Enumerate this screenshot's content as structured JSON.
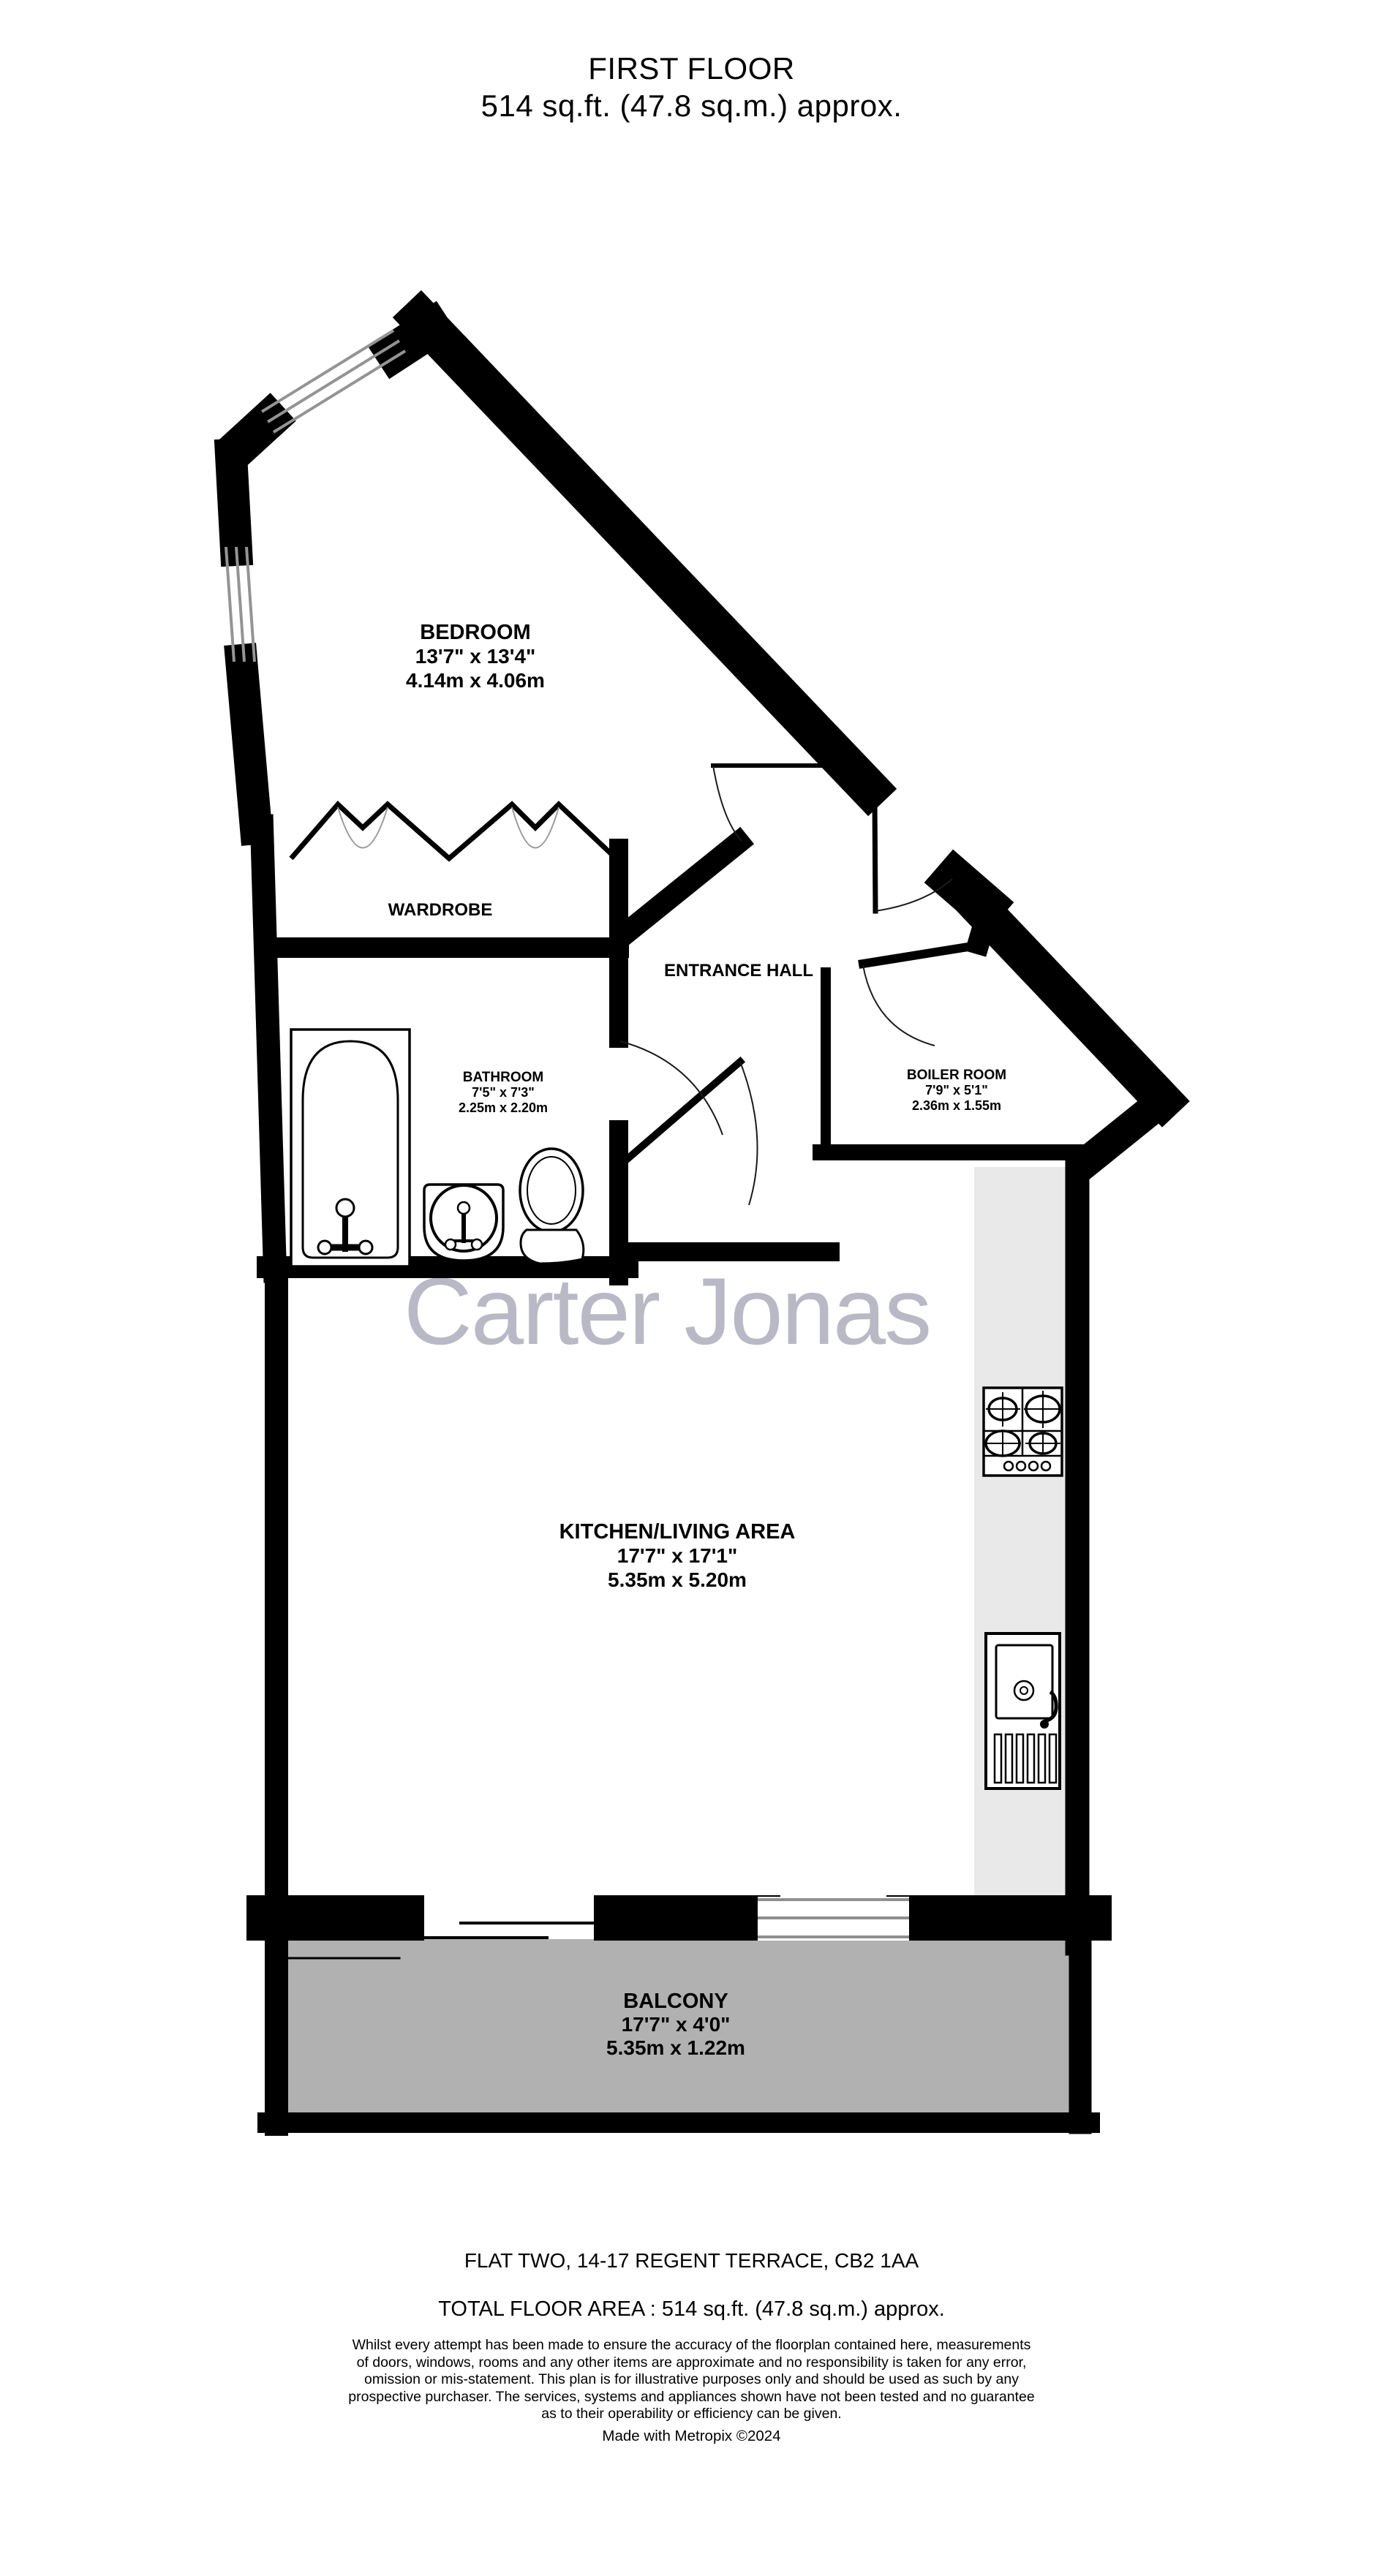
{
  "title": {
    "floor": "FIRST FLOOR",
    "area": "514 sq.ft. (47.8 sq.m.) approx."
  },
  "watermark": "Carter Jonas",
  "rooms": {
    "bedroom": {
      "name": "BEDROOM",
      "imperial": "13'7\"  x 13'4\"",
      "metric": "4.14m  x 4.06m"
    },
    "wardrobe": {
      "name": "WARDROBE"
    },
    "entrance_hall": {
      "name": "ENTRANCE HALL"
    },
    "bathroom": {
      "name": "BATHROOM",
      "imperial": "7'5\"  x 7'3\"",
      "metric": "2.25m  x 2.20m"
    },
    "boiler_room": {
      "name": "BOILER ROOM",
      "imperial": "7'9\"  x 5'1\"",
      "metric": "2.36m  x 1.55m"
    },
    "kitchen_living": {
      "name": "KITCHEN/LIVING AREA",
      "imperial": "17'7\"  x 17'1\"",
      "metric": "5.35m  x 5.20m"
    },
    "balcony": {
      "name": "BALCONY",
      "imperial": "17'7\"  x 4'0\"",
      "metric": "5.35m  x 1.22m"
    }
  },
  "symbols": [
    "bathtub-icon",
    "wash-basin-icon",
    "toilet-icon",
    "hob-icon",
    "kitchen-sink-icon",
    "wardrobe-rail-icon",
    "door-swing-arc",
    "window",
    "sliding-door"
  ],
  "footer": {
    "address": "FLAT TWO, 14-17 REGENT TERRACE, CB2 1AA",
    "total_area": "TOTAL FLOOR AREA : 514 sq.ft. (47.8 sq.m.) approx.",
    "disclaimer_lines": [
      "Whilst every attempt has been made to ensure the accuracy of the floorplan contained here, measurements",
      "of doors, windows, rooms and any other items are approximate and no responsibility is taken for any error,",
      "omission or mis-statement. This plan is for illustrative purposes only and should be used as such by any",
      "prospective purchaser. The services, systems and appliances shown have not been tested and no guarantee",
      "as to their operability or efficiency can be given."
    ],
    "credit": "Made with Metropix ©2024"
  },
  "colors": {
    "wall": "#000000",
    "balcony_fill": "#b1b1b1",
    "counter_fill": "#e9e9e9",
    "watermark": "#b9b9c6",
    "window_line": "#949494"
  }
}
